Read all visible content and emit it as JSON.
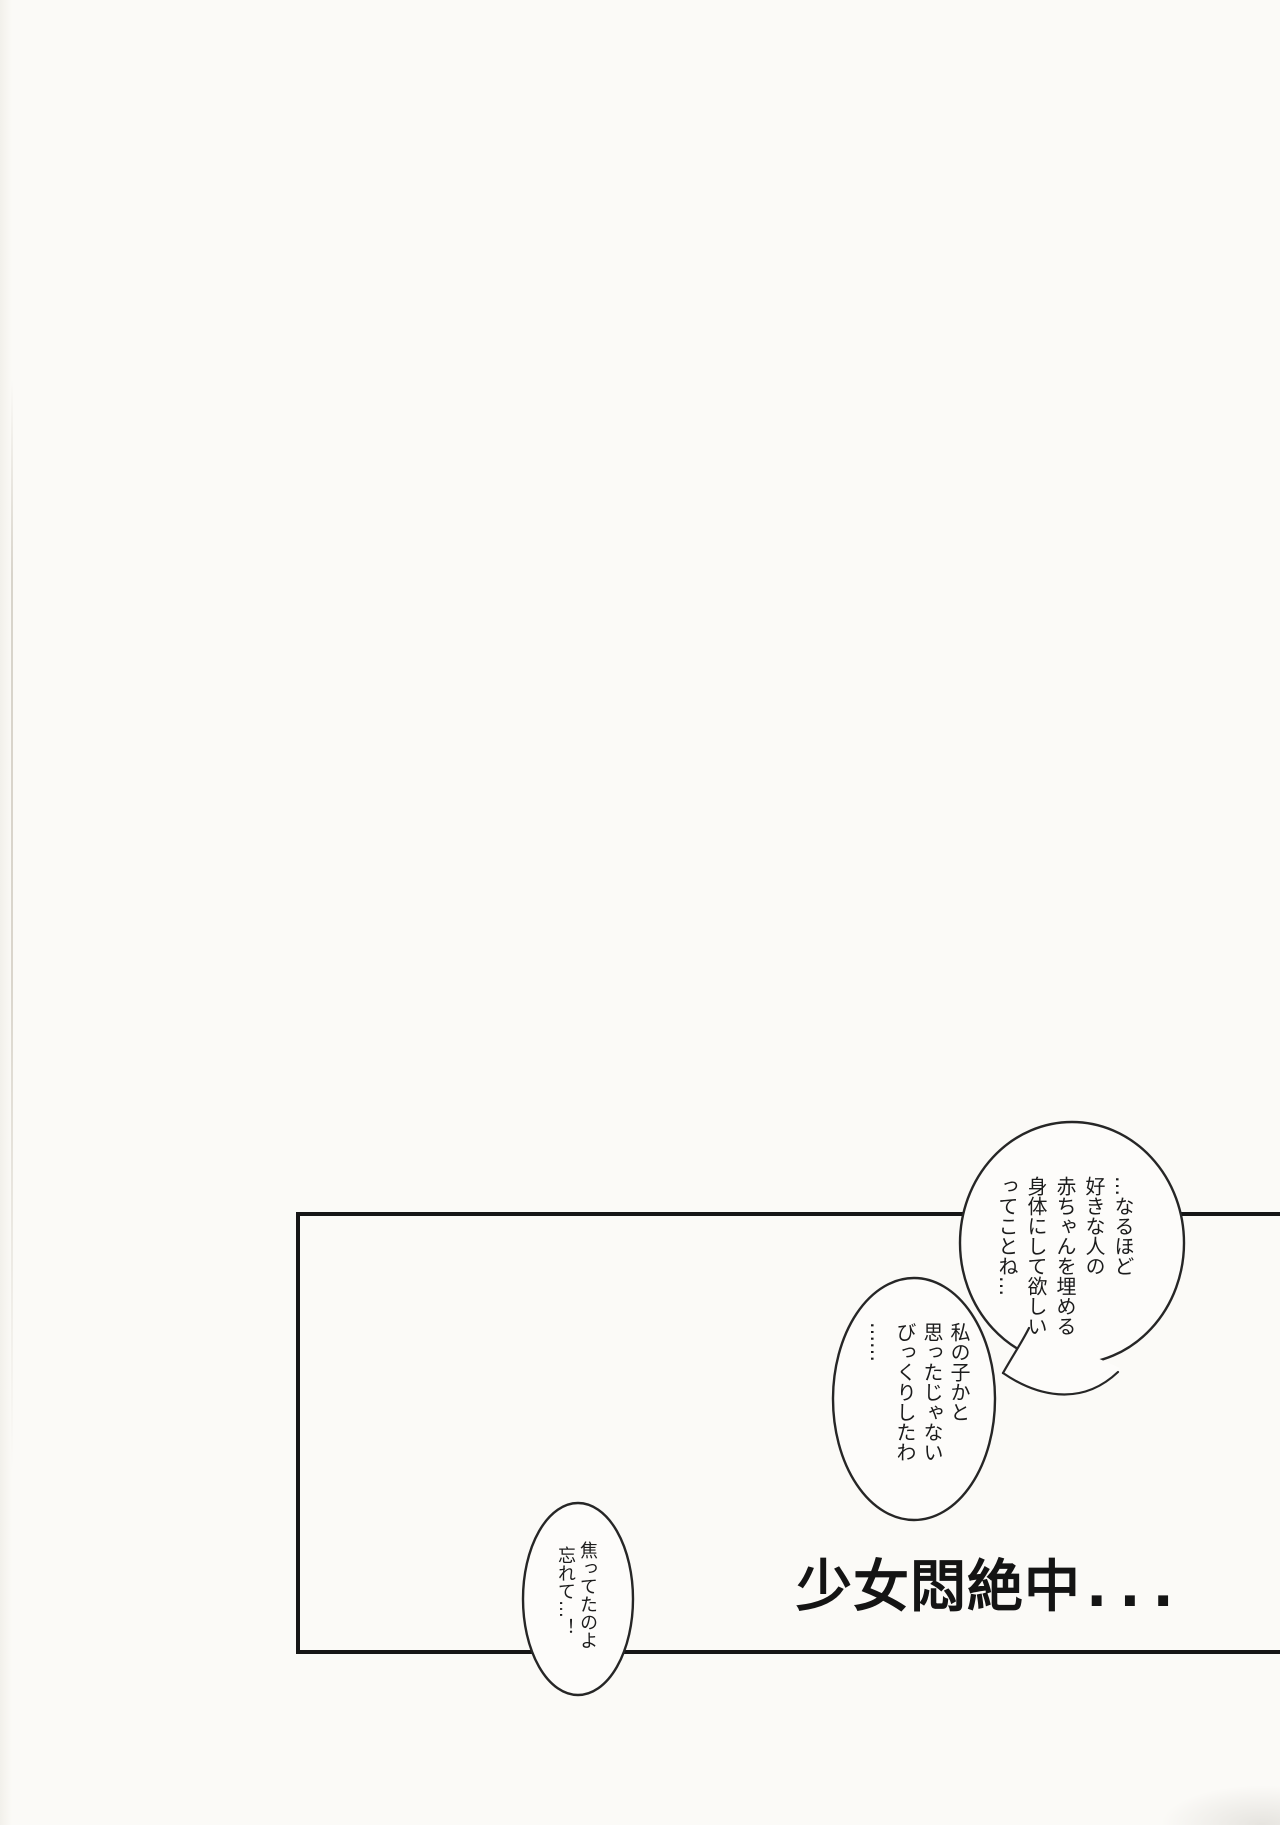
{
  "colors": {
    "paper": "#fbfaf7",
    "ink": "#262626",
    "panel_line": "#161616"
  },
  "panel": {
    "title_text": "少女悶絶中",
    "title_dots": "..."
  },
  "bubbles": [
    {
      "name": "speech-bubble-1",
      "lines": [
        "…なるほど",
        "好きな人の",
        "赤ちゃんを埋める",
        "身体にして欲しい",
        "ってことね…"
      ]
    },
    {
      "name": "speech-bubble-2",
      "lines": [
        "私の子かと",
        "思ったじゃない",
        "びっくりしたわ",
        "……"
      ]
    },
    {
      "name": "speech-bubble-3",
      "lines": [
        "焦ってたのよ",
        "忘れて…！"
      ]
    }
  ]
}
